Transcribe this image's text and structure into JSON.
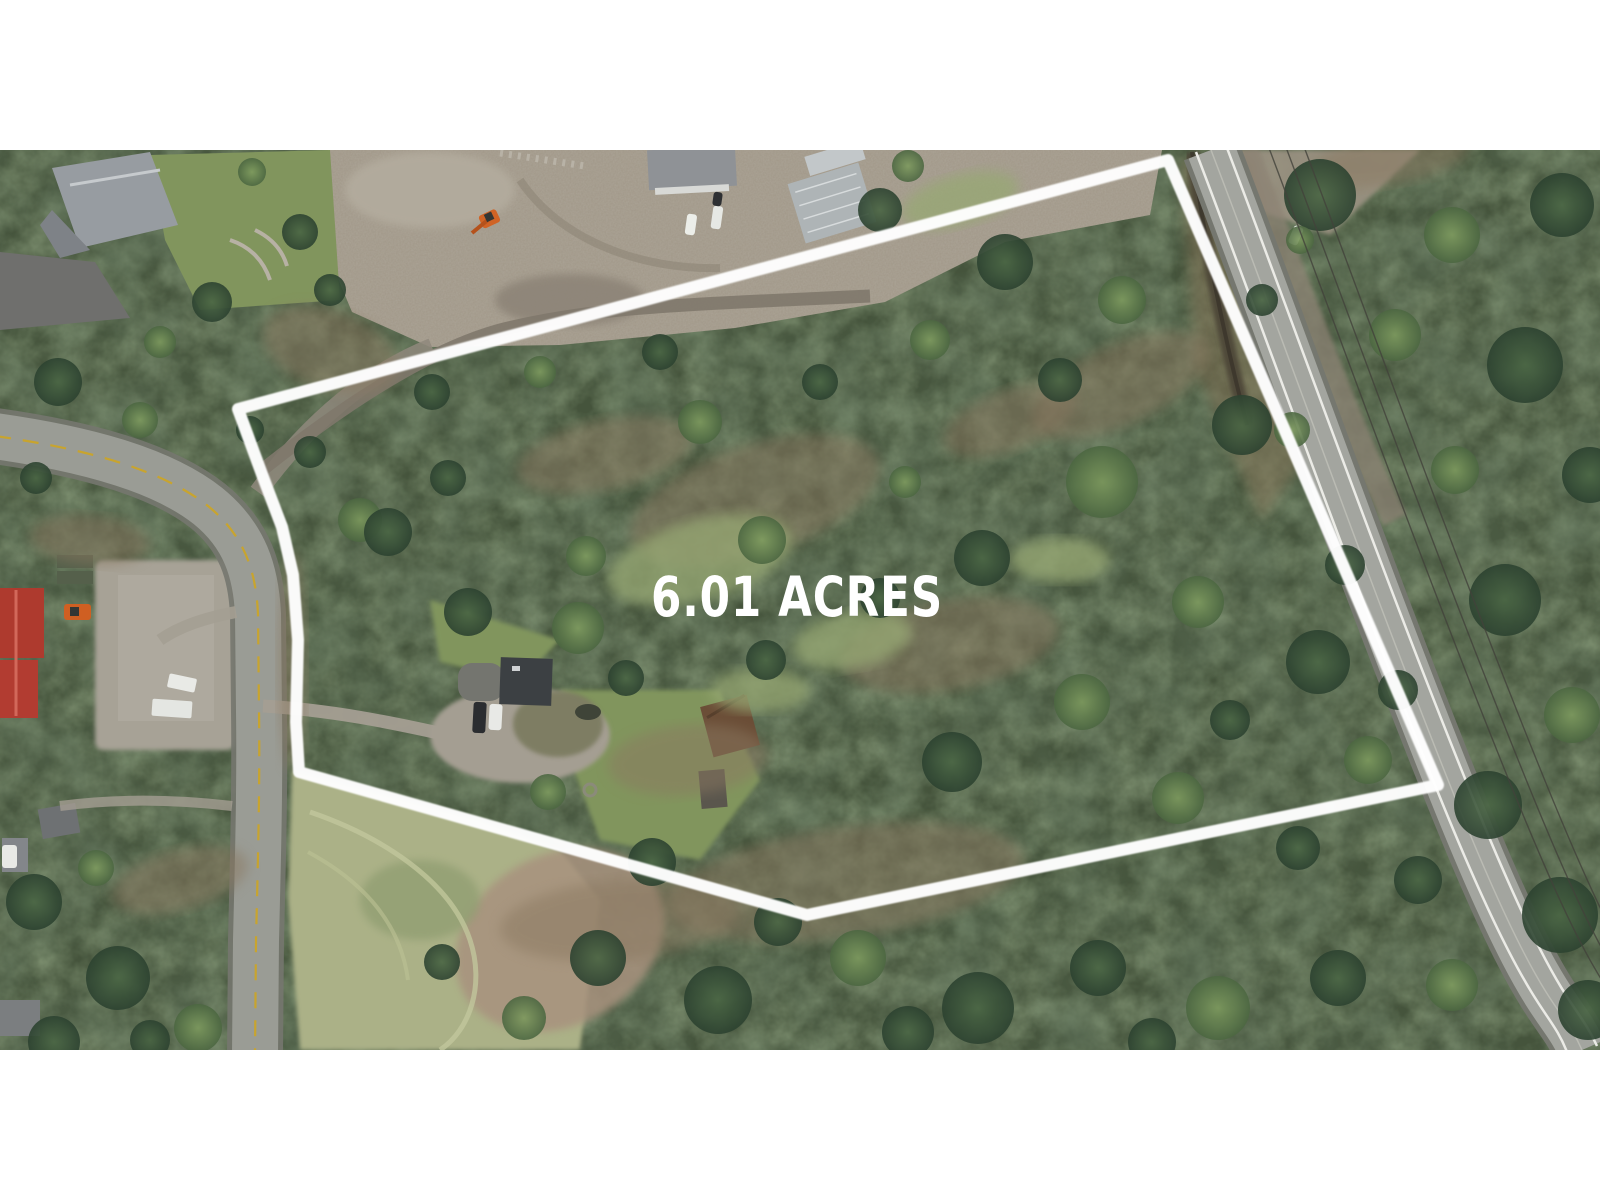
{
  "overlay": {
    "acreage_label": "6.01 ACRES",
    "label_color": "#ffffff",
    "boundary_color": "#ffffff",
    "boundary_points": "238,409 1168,160 1438,785 807,915 299,772 296,722 298,640 293,575 282,527 263,477"
  },
  "colors": {
    "white": "#ffffff",
    "forest_base": "#45543c",
    "canopy_light": "#7d9a5e",
    "canopy_dark": "#2c4230",
    "dirt": "#a39a8b",
    "gravel": "#a49e92",
    "slab": "#a7a296",
    "road": "#9a9c95",
    "road_edge": "#75776f",
    "highway": "#a3a59f",
    "fogline": "#ebebe6",
    "yellow_line": "#c8a42e",
    "meadow": "#abb187",
    "meadow_dry": "#a8927e",
    "lawn": "#81955d",
    "glade": "#97a873",
    "brush": "#8a7860",
    "roof_red": "#ae3a2e",
    "roof_gray": "#979ca1",
    "roof_metal": "#aeb4b6",
    "cabin_brown": "#6b4e37",
    "house_dark": "#3c4043",
    "creek": "#494236",
    "wire": "#42423b"
  },
  "scene": {
    "trees": [
      [
        1320,
        195,
        36,
        "D"
      ],
      [
        1452,
        235,
        28,
        "L"
      ],
      [
        1562,
        205,
        32,
        "D"
      ],
      [
        1395,
        335,
        26,
        "L"
      ],
      [
        1525,
        365,
        38,
        "D"
      ],
      [
        1590,
        475,
        28,
        "D"
      ],
      [
        1455,
        470,
        24,
        "L"
      ],
      [
        1505,
        600,
        36,
        "D"
      ],
      [
        1572,
        715,
        28,
        "L"
      ],
      [
        1488,
        805,
        34,
        "D"
      ],
      [
        1560,
        915,
        38,
        "D"
      ],
      [
        1452,
        985,
        26,
        "L"
      ],
      [
        1588,
        1010,
        30,
        "D"
      ],
      [
        1418,
        880,
        24,
        "D"
      ],
      [
        1262,
        300,
        16,
        "D"
      ],
      [
        1292,
        430,
        18,
        "L"
      ],
      [
        1345,
        565,
        20,
        "D"
      ],
      [
        1398,
        690,
        20,
        "D"
      ],
      [
        1300,
        240,
        14,
        "L"
      ],
      [
        1005,
        262,
        28,
        "D"
      ],
      [
        1122,
        300,
        24,
        "L"
      ],
      [
        1242,
        425,
        30,
        "D"
      ],
      [
        1102,
        482,
        36,
        "L"
      ],
      [
        982,
        558,
        28,
        "D"
      ],
      [
        1198,
        602,
        26,
        "L"
      ],
      [
        1318,
        662,
        32,
        "D"
      ],
      [
        1082,
        702,
        28,
        "L"
      ],
      [
        952,
        762,
        30,
        "D"
      ],
      [
        1178,
        798,
        26,
        "L"
      ],
      [
        1298,
        848,
        22,
        "D"
      ],
      [
        1368,
        760,
        24,
        "L"
      ],
      [
        1060,
        380,
        22,
        "D"
      ],
      [
        930,
        340,
        20,
        "L"
      ],
      [
        1230,
        720,
        20,
        "D"
      ],
      [
        700,
        422,
        22,
        "L"
      ],
      [
        820,
        382,
        18,
        "D"
      ],
      [
        762,
        540,
        24,
        "L"
      ],
      [
        880,
        598,
        20,
        "D"
      ],
      [
        905,
        482,
        16,
        "L"
      ],
      [
        448,
        478,
        18,
        "D"
      ],
      [
        360,
        520,
        22,
        "L"
      ],
      [
        310,
        452,
        16,
        "D"
      ],
      [
        388,
        532,
        24,
        "D"
      ],
      [
        540,
        372,
        16,
        "L"
      ],
      [
        660,
        352,
        18,
        "D"
      ],
      [
        432,
        392,
        18,
        "D"
      ],
      [
        880,
        210,
        22,
        "D"
      ],
      [
        908,
        166,
        16,
        "L"
      ],
      [
        468,
        612,
        24,
        "D"
      ],
      [
        578,
        628,
        26,
        "L"
      ],
      [
        626,
        678,
        18,
        "D"
      ],
      [
        766,
        660,
        20,
        "D"
      ],
      [
        548,
        792,
        18,
        "L"
      ],
      [
        652,
        862,
        24,
        "D"
      ],
      [
        586,
        556,
        20,
        "L"
      ],
      [
        598,
        958,
        28,
        "D"
      ],
      [
        718,
        1000,
        34,
        "D"
      ],
      [
        858,
        958,
        28,
        "L"
      ],
      [
        978,
        1008,
        36,
        "D"
      ],
      [
        1098,
        968,
        28,
        "D"
      ],
      [
        1218,
        1008,
        32,
        "L"
      ],
      [
        1338,
        978,
        28,
        "D"
      ],
      [
        524,
        1018,
        22,
        "L"
      ],
      [
        442,
        962,
        18,
        "D"
      ],
      [
        778,
        922,
        24,
        "D"
      ],
      [
        908,
        1032,
        26,
        "D"
      ],
      [
        1152,
        1042,
        24,
        "D"
      ],
      [
        58,
        382,
        24,
        "D"
      ],
      [
        140,
        420,
        18,
        "L"
      ],
      [
        36,
        478,
        16,
        "D"
      ],
      [
        34,
        902,
        28,
        "D"
      ],
      [
        118,
        978,
        32,
        "D"
      ],
      [
        198,
        1028,
        24,
        "L"
      ],
      [
        54,
        1042,
        26,
        "D"
      ],
      [
        150,
        1040,
        20,
        "D"
      ],
      [
        96,
        868,
        18,
        "L"
      ],
      [
        252,
        172,
        14,
        "L"
      ],
      [
        300,
        232,
        18,
        "D"
      ],
      [
        212,
        302,
        20,
        "D"
      ],
      [
        160,
        342,
        16,
        "L"
      ],
      [
        330,
        290,
        16,
        "D"
      ],
      [
        250,
        430,
        14,
        "D"
      ]
    ],
    "brush_patches": [
      [
        755,
        500,
        130,
        55,
        -18
      ],
      [
        950,
        645,
        110,
        45,
        -10
      ],
      [
        1120,
        385,
        95,
        40,
        -25
      ],
      [
        688,
        760,
        80,
        35,
        -5
      ],
      [
        845,
        882,
        180,
        55,
        -8
      ],
      [
        605,
        455,
        90,
        35,
        -12
      ],
      [
        1010,
        420,
        70,
        30,
        -20
      ],
      [
        330,
        350,
        70,
        40,
        20
      ],
      [
        90,
        540,
        60,
        25,
        5
      ],
      [
        180,
        880,
        70,
        30,
        -15
      ],
      [
        620,
        920,
        120,
        40,
        -5
      ],
      [
        1390,
        160,
        80,
        25,
        -10
      ],
      [
        292,
        660,
        14,
        110,
        0
      ]
    ],
    "glades": [
      [
        700,
        560,
        95,
        40,
        -15
      ],
      [
        852,
        640,
        60,
        28,
        -10
      ],
      [
        960,
        200,
        60,
        25,
        -15
      ],
      [
        1060,
        560,
        50,
        22,
        0
      ],
      [
        760,
        690,
        50,
        22,
        0
      ]
    ]
  }
}
